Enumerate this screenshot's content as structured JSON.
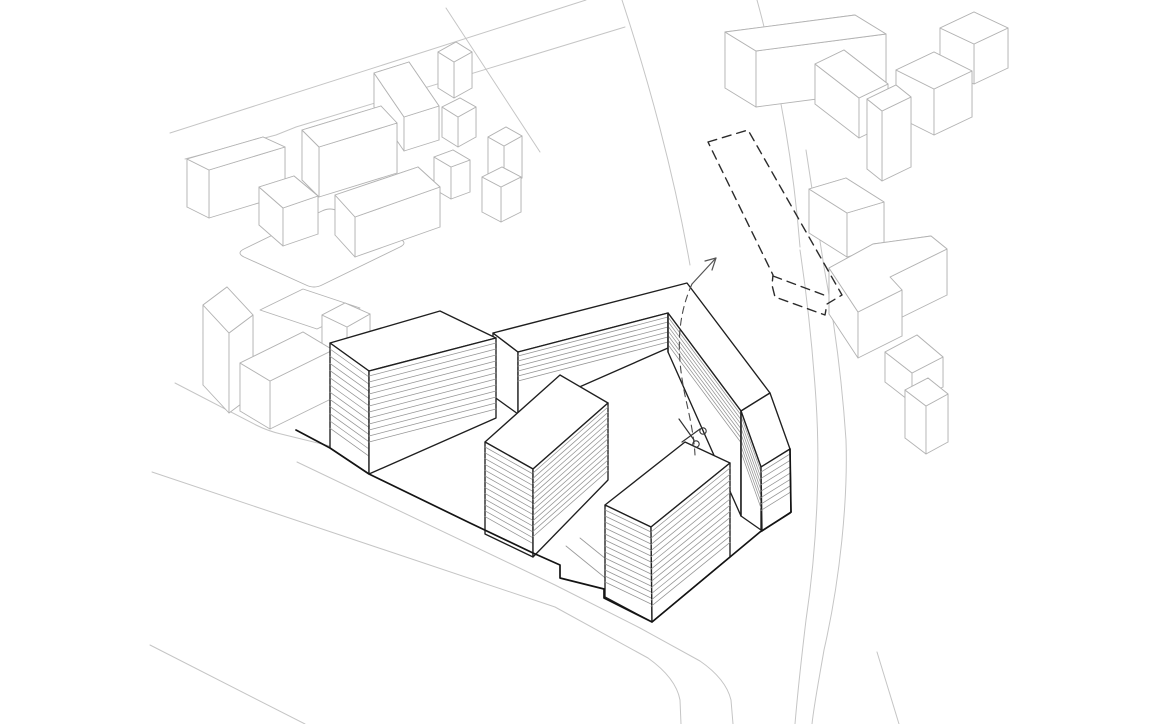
{
  "canvas": {
    "w": 1159,
    "h": 724,
    "bg": "#ffffff"
  },
  "styles": {
    "street": {
      "stroke": "#c5c5c5",
      "width": 1.0
    },
    "context": {
      "stroke": "#b3b3b3",
      "width": 0.9
    },
    "building": {
      "stroke": "#1f1f1f",
      "width": 1.35
    },
    "heavy": {
      "stroke": "#141414",
      "width": 1.7
    },
    "hatch": {
      "stroke": "#949494",
      "width": 0.75
    },
    "ground": {
      "stroke": "#9a9a9a",
      "width": 0.85
    },
    "dashed": {
      "stroke": "#2b2b2b",
      "width": 1.4,
      "dash": "9 6"
    },
    "cut": {
      "stroke": "#4a4a4a",
      "width": 1.1,
      "dash": "7 5"
    },
    "annot": {
      "stroke": "#555555",
      "width": 1.2
    }
  },
  "streets": [
    {
      "name": "street-nw-upper",
      "d": "M170,133 L586,0"
    },
    {
      "name": "street-nw-lower",
      "d": "M185,159 L276,135 Q286,131 296,127 L625,27"
    },
    {
      "name": "street-top-diagonal",
      "d": "M446,8 L540,152"
    },
    {
      "name": "street-ne-left-curb",
      "d": "M622,0 Q668,140 690,265"
    },
    {
      "name": "street-ne-right-curb",
      "d": "M757,0 Q790,120 800,247"
    },
    {
      "name": "road-east-outer",
      "d": "M800,250 C806,290 812,340 816,400 C820,460 818,540 806,620 C800,670 797,700 795,724"
    },
    {
      "name": "road-east-inner",
      "d": "M806,150 C814,200 820,240 824,267 C834,320 842,380 846,440 C848,500 840,580 824,650 C818,685 814,705 812,724"
    },
    {
      "name": "road-east-tail",
      "d": "M877,652 L899,724"
    },
    {
      "name": "street-sw-north-curb",
      "d": "M297,462 L555,585 L640,628 L700,661 Q726,679 731,700 L733,724"
    },
    {
      "name": "street-sw-south-curb",
      "d": "M152,472 L555,607 L648,658 Q676,678 680,700 L681,724"
    },
    {
      "name": "street-sw-far-line",
      "d": "M150,645 L305,724"
    },
    {
      "name": "sidewalk-west-of-site",
      "d": "M175,383 L256,425 Q268,431 281,434 L330,446"
    },
    {
      "name": "courtyard-path-line-1",
      "d": "M566,546 L652,616"
    },
    {
      "name": "courtyard-path-line-2",
      "d": "M580,538 L664,606"
    }
  ],
  "context": {
    "flats": [
      {
        "name": "plaza-rounded-outline",
        "d": "M244,249 L322,211 Q330,207 338,211 L400,239 Q408,243 400,247 L322,285 Q314,289 306,285 L244,257 Q236,253 244,249 Z"
      },
      {
        "name": "ground-pad-outline",
        "d": "M260,310 L303,289 L360,308 L317,329 Z"
      }
    ],
    "boxes": [
      {
        "name": "context-box-nw-b",
        "top": [
          [
            187,
            159
          ],
          [
            263,
            137
          ],
          [
            285,
            147
          ],
          [
            209,
            170
          ]
        ],
        "h": 48
      },
      {
        "name": "context-box-nw-c",
        "top": [
          [
            302,
            130
          ],
          [
            381,
            106
          ],
          [
            397,
            123
          ],
          [
            319,
            147
          ]
        ],
        "h": 50
      },
      {
        "name": "context-box-nw-d",
        "top": [
          [
            374,
            73
          ],
          [
            409,
            62
          ],
          [
            439,
            106
          ],
          [
            404,
            117
          ]
        ],
        "h": 34
      },
      {
        "name": "context-box-nw-e",
        "top": [
          [
            438,
            52
          ],
          [
            456,
            42
          ],
          [
            472,
            52
          ],
          [
            454,
            62
          ]
        ],
        "h": 36
      },
      {
        "name": "context-box-nw-g",
        "top": [
          [
            259,
            187
          ],
          [
            294,
            176
          ],
          [
            318,
            196
          ],
          [
            283,
            208
          ]
        ],
        "h": 38
      },
      {
        "name": "context-box-nw-h",
        "top": [
          [
            335,
            195
          ],
          [
            418,
            167
          ],
          [
            440,
            187
          ],
          [
            355,
            217
          ]
        ],
        "h": 40
      },
      {
        "name": "context-box-nw-i",
        "top": [
          [
            434,
            157
          ],
          [
            453,
            150
          ],
          [
            470,
            160
          ],
          [
            451,
            167
          ]
        ],
        "h": 32
      },
      {
        "name": "context-box-nw-j1",
        "top": [
          [
            442,
            107
          ],
          [
            460,
            98
          ],
          [
            476,
            107
          ],
          [
            458,
            117
          ]
        ],
        "h": 30
      },
      {
        "name": "context-box-nw-j2",
        "top": [
          [
            488,
            137
          ],
          [
            506,
            127
          ],
          [
            522,
            136
          ],
          [
            504,
            146
          ]
        ],
        "h": 42
      },
      {
        "name": "context-box-nw-j3",
        "top": [
          [
            482,
            177
          ],
          [
            502,
            167
          ],
          [
            521,
            177
          ],
          [
            501,
            187
          ]
        ],
        "h": 35
      },
      {
        "name": "context-box-w-tall",
        "top": [
          [
            203,
            305
          ],
          [
            227,
            287
          ],
          [
            253,
            315
          ],
          [
            229,
            333
          ]
        ],
        "h": 80
      },
      {
        "name": "context-box-w-low",
        "top": [
          [
            240,
            363
          ],
          [
            303,
            332
          ],
          [
            333,
            350
          ],
          [
            270,
            381
          ]
        ],
        "h": 48
      },
      {
        "name": "context-box-behind-a",
        "top": [
          [
            322,
            315
          ],
          [
            345,
            303
          ],
          [
            370,
            314
          ],
          [
            347,
            327
          ]
        ],
        "h": 30
      },
      {
        "name": "context-box-ne-slab",
        "top": [
          [
            725,
            32
          ],
          [
            855,
            15
          ],
          [
            886,
            34
          ],
          [
            756,
            51
          ]
        ],
        "h": 56
      },
      {
        "name": "context-box-ne-d",
        "top": [
          [
            815,
            64
          ],
          [
            844,
            50
          ],
          [
            888,
            84
          ],
          [
            859,
            98
          ]
        ],
        "h": 40
      },
      {
        "name": "context-box-ne-tall",
        "top": [
          [
            867,
            99
          ],
          [
            896,
            85
          ],
          [
            911,
            97
          ],
          [
            882,
            111
          ]
        ],
        "h": 70
      },
      {
        "name": "context-box-ne-f",
        "top": [
          [
            896,
            70
          ],
          [
            934,
            52
          ],
          [
            972,
            71
          ],
          [
            934,
            89
          ]
        ],
        "h": 46
      },
      {
        "name": "context-box-ne-g",
        "top": [
          [
            940,
            28
          ],
          [
            974,
            12
          ],
          [
            1008,
            28
          ],
          [
            974,
            44
          ]
        ],
        "h": 40
      },
      {
        "name": "context-box-by-dashed",
        "top": [
          [
            809,
            189
          ],
          [
            846,
            178
          ],
          [
            884,
            202
          ],
          [
            847,
            213
          ]
        ],
        "h": 44
      },
      {
        "name": "context-box-e-lshape",
        "top": [
          [
            829,
            268
          ],
          [
            873,
            244
          ],
          [
            931,
            236
          ],
          [
            947,
            249
          ],
          [
            890,
            277
          ],
          [
            902,
            290
          ],
          [
            858,
            312
          ]
        ],
        "h": 46
      },
      {
        "name": "context-box-se-1",
        "top": [
          [
            885,
            352
          ],
          [
            917,
            335
          ],
          [
            943,
            357
          ],
          [
            912,
            373
          ]
        ],
        "h": 30
      },
      {
        "name": "context-box-se-2",
        "top": [
          [
            905,
            390
          ],
          [
            928,
            378
          ],
          [
            948,
            394
          ],
          [
            926,
            406
          ]
        ],
        "h": 48
      }
    ]
  },
  "site": {
    "faces": [
      {
        "name": "slab-west-end-face",
        "pts": [
          [
            493,
            333
          ],
          [
            518,
            352
          ],
          [
            518,
            414
          ],
          [
            493,
            396
          ]
        ]
      },
      {
        "name": "slab-roof",
        "pts": [
          [
            493,
            333
          ],
          [
            687,
            283
          ],
          [
            770,
            393
          ],
          [
            741,
            411
          ],
          [
            668,
            313
          ],
          [
            518,
            352
          ]
        ]
      },
      {
        "name": "slab-north-wing-facade",
        "pts": [
          [
            518,
            352
          ],
          [
            668,
            313
          ],
          [
            668,
            348
          ],
          [
            518,
            414
          ]
        ],
        "hatch": {
          "n": 6,
          "step": 5.0,
          "start": 4
        }
      },
      {
        "name": "slab-east-wing-facade",
        "pts": [
          [
            668,
            313
          ],
          [
            741,
            411
          ],
          [
            741,
            516
          ],
          [
            668,
            352
          ]
        ],
        "hatch": {
          "n": 7,
          "step": 4.6,
          "start": 4
        }
      },
      {
        "name": "slab-end-roof",
        "pts": [
          [
            770,
            393
          ],
          [
            790,
            449
          ],
          [
            761,
            467
          ],
          [
            741,
            411
          ]
        ]
      },
      {
        "name": "slab-end-west-facade",
        "pts": [
          [
            741,
            411
          ],
          [
            761,
            467
          ],
          [
            761,
            530
          ],
          [
            741,
            516
          ]
        ],
        "hatch": {
          "n": 7,
          "step": 6.0,
          "start": 5
        }
      },
      {
        "name": "slab-end-south-facade",
        "pts": [
          [
            761,
            467
          ],
          [
            790,
            449
          ],
          [
            791,
            512
          ],
          [
            762,
            531
          ]
        ],
        "hatch": {
          "n": 7,
          "step": 6.4,
          "start": 5
        }
      },
      {
        "name": "building-a-roof",
        "pts": [
          [
            330,
            343
          ],
          [
            440,
            311
          ],
          [
            496,
            338
          ],
          [
            369,
            371
          ]
        ]
      },
      {
        "name": "building-a-west-facade",
        "pts": [
          [
            330,
            343
          ],
          [
            369,
            371
          ],
          [
            369,
            474
          ],
          [
            330,
            448
          ]
        ],
        "hatch": {
          "n": 12,
          "step": 7.2,
          "start": 6
        }
      },
      {
        "name": "building-a-south-facade",
        "pts": [
          [
            369,
            371
          ],
          [
            496,
            338
          ],
          [
            496,
            418
          ],
          [
            369,
            474
          ]
        ],
        "hatch": {
          "n": 12,
          "step": 6.0,
          "start": 5
        }
      },
      {
        "name": "tower-b-roof",
        "pts": [
          [
            485,
            442
          ],
          [
            560,
            375
          ],
          [
            608,
            403
          ],
          [
            533,
            469
          ]
        ]
      },
      {
        "name": "tower-b-west-facade",
        "pts": [
          [
            485,
            442
          ],
          [
            533,
            469
          ],
          [
            533,
            557
          ],
          [
            485,
            534
          ]
        ],
        "hatch": {
          "n": 13,
          "step": 5.8,
          "start": 5
        }
      },
      {
        "name": "tower-b-east-facade",
        "pts": [
          [
            533,
            469
          ],
          [
            608,
            403
          ],
          [
            608,
            480
          ],
          [
            533,
            557
          ]
        ],
        "hatch": {
          "n": 13,
          "step": 5.3,
          "start": 4
        }
      },
      {
        "name": "tower-c-roof",
        "pts": [
          [
            605,
            505
          ],
          [
            685,
            442
          ],
          [
            730,
            463
          ],
          [
            651,
            527
          ]
        ]
      },
      {
        "name": "tower-c-west-facade",
        "pts": [
          [
            605,
            505
          ],
          [
            651,
            527
          ],
          [
            652,
            622
          ],
          [
            605,
            597
          ]
        ],
        "hatch": {
          "n": 13,
          "step": 6.0,
          "start": 5
        }
      },
      {
        "name": "tower-c-east-facade",
        "pts": [
          [
            651,
            527
          ],
          [
            730,
            463
          ],
          [
            730,
            557
          ],
          [
            652,
            622
          ]
        ],
        "hatch": {
          "n": 13,
          "step": 6.2,
          "start": 5
        }
      }
    ],
    "lines": [
      {
        "name": "slab-bend-inner-edge",
        "d": "M668,313 L668,352",
        "style": "building"
      },
      {
        "name": "slab-step-edge",
        "d": "M741,411 L741,516",
        "style": "building"
      },
      {
        "name": "slab-end-outer-edge",
        "d": "M790,449 L791,512",
        "style": "heavy"
      }
    ],
    "boundary": {
      "name": "site-boundary",
      "d": "M296,430 L330,448 L369,474 L470,523 L533,553 L560,565 L560,578 L604,589 L604,598 L652,622 L730,557 L760,532 L790,513 L791,512"
    }
  },
  "annotation": {
    "dashed_volume": {
      "outline_d": "M708,142 L748,130 L842,295 L827,304 L825,315 L775,297 L772,285 L773,275 Z",
      "inner_d": "M773,276 L824,295"
    },
    "cut_line": {
      "d": "M692,284 C678,315 675,350 686,400 C690,418 694,436 695,455"
    },
    "arrow": {
      "shaft_d": "M692,284 L716,258",
      "head_d": "M705,261 L716,258 L712,270"
    },
    "scissors": {
      "blade1_d": "M679,419 L694,440",
      "blade2_d": "M682,442 L700,429",
      "rings": [
        {
          "cx": 696,
          "cy": 444,
          "r": 3.2
        },
        {
          "cx": 703,
          "cy": 431,
          "r": 3.2
        }
      ]
    }
  }
}
